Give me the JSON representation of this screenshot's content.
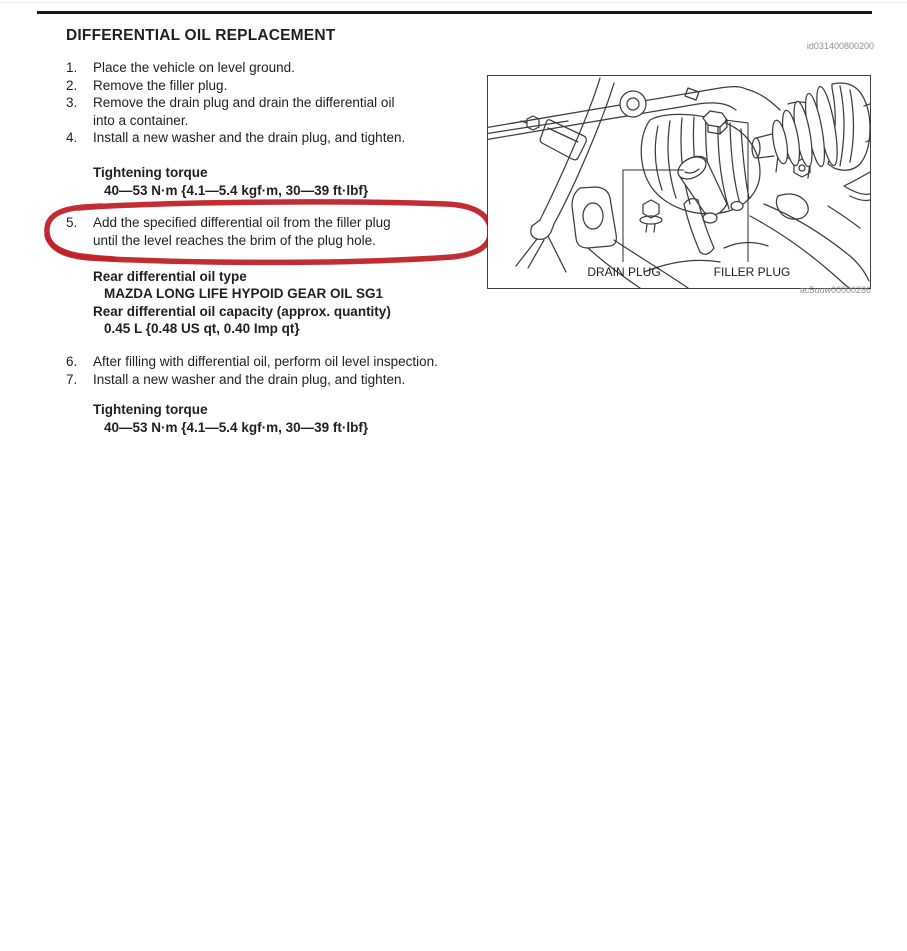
{
  "page": {
    "title": "DIFFERENTIAL OIL REPLACEMENT",
    "doc_id": "id031400800200"
  },
  "steps": [
    {
      "num": "1.",
      "text": "Place the vehicle on level ground."
    },
    {
      "num": "2.",
      "text": "Remove the filler plug."
    },
    {
      "num": "3.",
      "text": "Remove the drain plug and drain the differential oil\ninto a container."
    },
    {
      "num": "4.",
      "text": "Install a new washer and the drain plug, and tighten."
    }
  ],
  "torque1": {
    "label": "Tightening torque",
    "value": "40—53 N·m {4.1—5.4 kgf·m, 30—39 ft·lbf}"
  },
  "step5": {
    "num": "5.",
    "text": "Add the specified differential oil from the filler plug\nuntil the level reaches the brim of the plug hole."
  },
  "oil_spec": {
    "type_label": "Rear differential oil type",
    "type_value": "MAZDA LONG LIFE HYPOID GEAR OIL SG1",
    "capacity_label": "Rear differential oil capacity (approx. quantity)",
    "capacity_value": "0.45 L {0.48 US qt, 0.40 Imp qt}"
  },
  "steps_after": [
    {
      "num": "6.",
      "text": "After filling with differential oil, perform oil level inspection."
    },
    {
      "num": "7.",
      "text": "Install a new washer and the drain plug, and tighten."
    }
  ],
  "torque2": {
    "label": "Tightening torque",
    "value": "40—53 N·m {4.1—5.4 kgf·m, 30—39 ft·lbf}"
  },
  "figure": {
    "drain_label": "DRAIN PLUG",
    "filler_label": "FILLER PLUG",
    "code": "ac5uuw00000286"
  },
  "colors": {
    "annotation_red": "#c1232b",
    "text": "#1f1f1f",
    "muted_gray": "#8d8d8d",
    "diagram_line": "#3c3c3c",
    "rule_black": "#191919"
  }
}
